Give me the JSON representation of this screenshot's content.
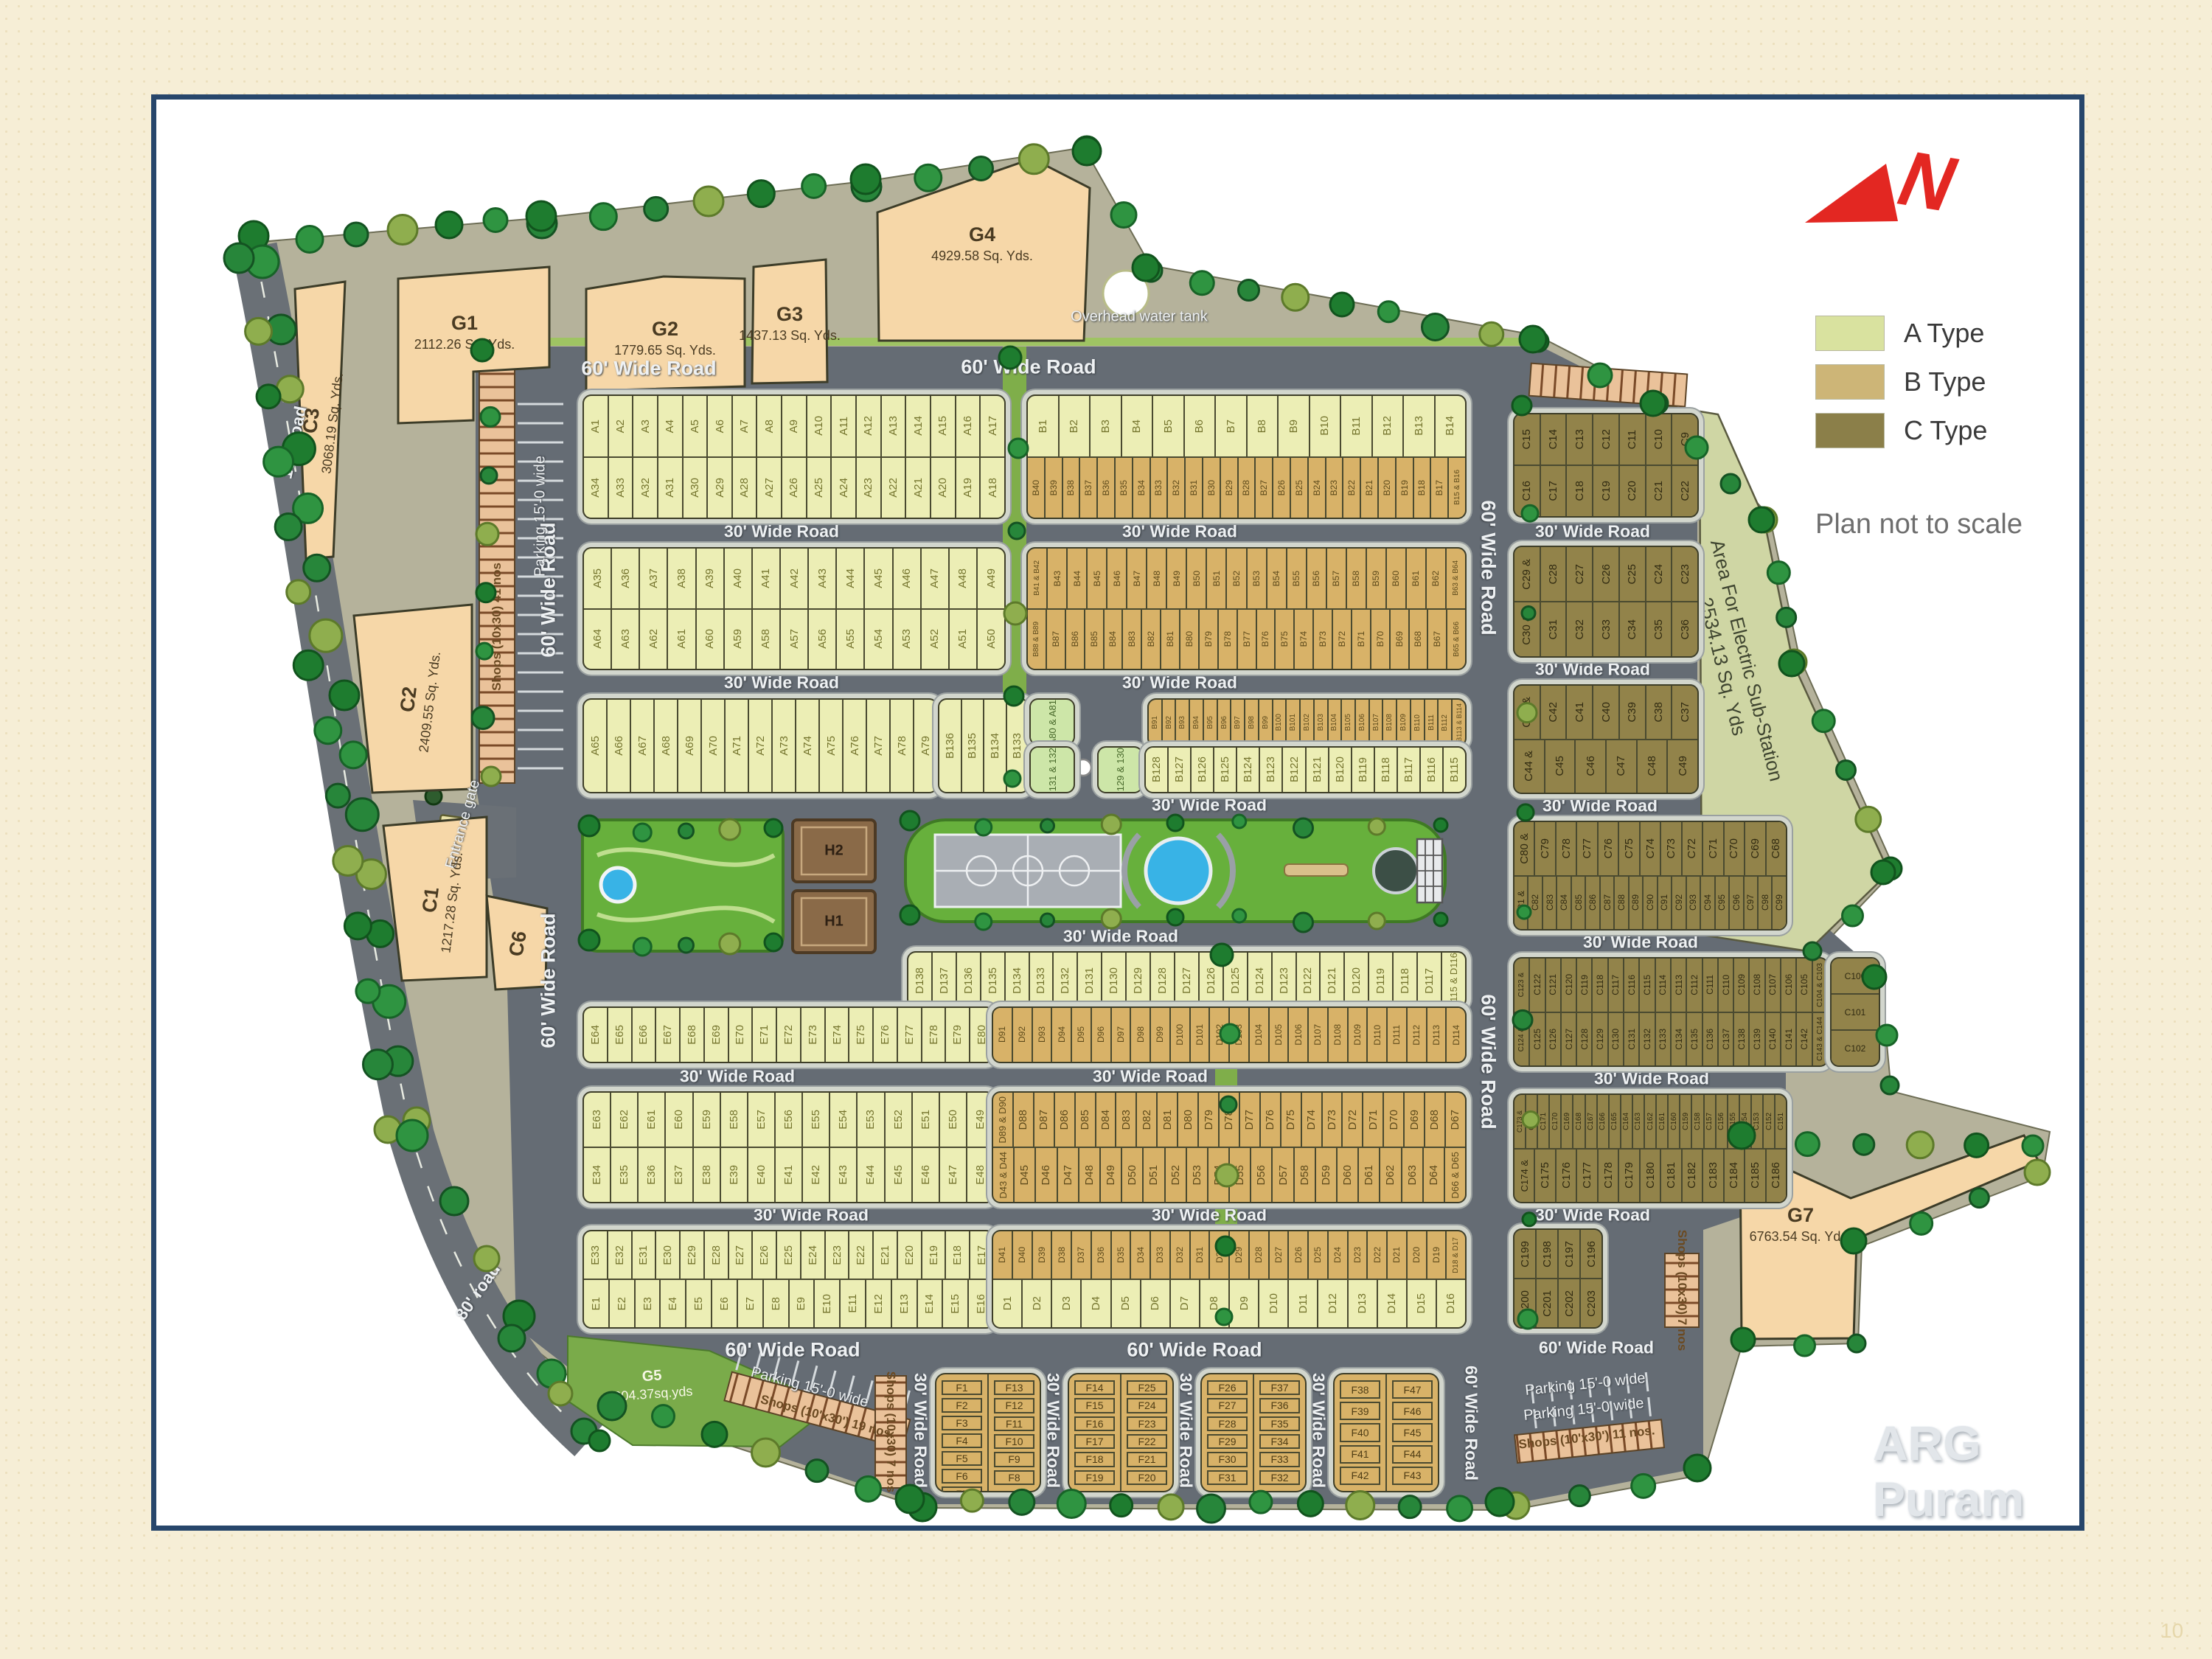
{
  "title": "ARG Puram",
  "page_number": "10",
  "north_letter": "N",
  "legend": {
    "items": [
      {
        "label": "A Type",
        "color": "#d9e29f"
      },
      {
        "label": "B Type",
        "color": "#cdb577"
      },
      {
        "label": "C Type",
        "color": "#8b7f49"
      }
    ],
    "note": "Plan not to scale"
  },
  "roads": {
    "sixty": "60' Wide Road",
    "thirty": "30' Wide Road",
    "hundred": "100' road",
    "eighty": "80' road"
  },
  "landmarks": {
    "tank": "Overhead water tank",
    "entrance": "Entrance gate",
    "substation_line1": "Area For Electric Sub-Station",
    "substation_line2": "2534.13 Sq. Yds"
  },
  "shops": {
    "parking15": "Parking 15'-0 wide",
    "shops41": "Shops (10x30) 41 nos",
    "shops19": "Shops (10'x30') 19 nos.",
    "shops11": "Shops (10'x30') 11 nos.",
    "shops7": "Shops (10x30) 7 nos"
  },
  "plots": {
    "G1": {
      "name": "G1",
      "area": "2112.26 Sq. Yds."
    },
    "G2": {
      "name": "G2",
      "area": "1779.65 Sq. Yds."
    },
    "G3": {
      "name": "G3",
      "area": "1437.13 Sq. Yds."
    },
    "G4": {
      "name": "G4",
      "area": "4929.58 Sq. Yds."
    },
    "G5": {
      "name": "G5",
      "area": "804.37sq.yds"
    },
    "G7": {
      "name": "G7",
      "area": "6763.54 Sq. Yda."
    },
    "C1": {
      "name": "C1",
      "area": "1217.28 Sq. Yds."
    },
    "C2": {
      "name": "C2",
      "area": "2409.55 Sq. Yds."
    },
    "C3": {
      "name": "C3",
      "area": "3068.19 Sq. Yds."
    },
    "C6": {
      "name": "C6",
      "area": ""
    },
    "H1": {
      "name": "H1"
    },
    "H2": {
      "name": "H2"
    }
  },
  "blocks": {
    "r1lt": [
      "A1",
      "A2",
      "A3",
      "A4",
      "A5",
      "A6",
      "A7",
      "A8",
      "A9",
      "A10",
      "A11",
      "A12",
      "A13",
      "A14",
      "A15",
      "A16",
      "A17"
    ],
    "r1lb": [
      "A34",
      "A33",
      "A32",
      "A31",
      "A30",
      "A29",
      "A28",
      "A27",
      "A26",
      "A25",
      "A24",
      "A23",
      "A22",
      "A21",
      "A20",
      "A19",
      "A18"
    ],
    "r1rt": [
      "B1",
      "B2",
      "B3",
      "B4",
      "B5",
      "B6",
      "B7",
      "B8",
      "B9",
      "B10",
      "B11",
      "B12",
      "B13",
      "B14"
    ],
    "r1rb": [
      "B40",
      "B39",
      "B38",
      "B37",
      "B36",
      "B35",
      "B34",
      "B33",
      "B32",
      "B31",
      "B30",
      "B29",
      "B28",
      "B27",
      "B26",
      "B25",
      "B24",
      "B23",
      "B22",
      "B21",
      "B20",
      "B19",
      "B18",
      "B17",
      "B15 & B16"
    ],
    "r2lt": [
      "A35",
      "A36",
      "A37",
      "A38",
      "A39",
      "A40",
      "A41",
      "A42",
      "A43",
      "A44",
      "A45",
      "A46",
      "A47",
      "A48",
      "A49"
    ],
    "r2lb": [
      "A64",
      "A63",
      "A62",
      "A61",
      "A60",
      "A59",
      "A58",
      "A57",
      "A56",
      "A55",
      "A54",
      "A53",
      "A52",
      "A51",
      "A50"
    ],
    "r2rt": [
      "B41 & B42",
      "B43",
      "B44",
      "B45",
      "B46",
      "B47",
      "B48",
      "B49",
      "B50",
      "B51",
      "B52",
      "B53",
      "B54",
      "B55",
      "B56",
      "B57",
      "B58",
      "B59",
      "B60",
      "B61",
      "B62",
      "B63 & B64"
    ],
    "r2rb": [
      "B88 & B89",
      "B87",
      "B86",
      "B85",
      "B84",
      "B83",
      "B82",
      "B81",
      "B80",
      "B79",
      "B78",
      "B77",
      "B76",
      "B75",
      "B74",
      "B73",
      "B72",
      "B71",
      "B70",
      "B69",
      "B68",
      "B67",
      "B65 & B66"
    ],
    "r3l": [
      "A65",
      "A66",
      "A67",
      "A68",
      "A69",
      "A70",
      "A71",
      "A72",
      "A73",
      "A74",
      "A75",
      "A76",
      "A77",
      "A78",
      "A79"
    ],
    "r3m": [
      "B136",
      "B135",
      "B134",
      "B133"
    ],
    "gA80": [
      "A80 & A81"
    ],
    "gB131": [
      "B131 & 132"
    ],
    "gB129": [
      "B129 & 130"
    ],
    "r3rt": [
      "B91",
      "B92",
      "B93",
      "B94",
      "B95",
      "B96",
      "B97",
      "B98",
      "B99",
      "B100",
      "B101",
      "B102",
      "B103",
      "B104",
      "B105",
      "B106",
      "B107",
      "B108",
      "B109",
      "B110",
      "B111",
      "B112",
      "B113 & B114"
    ],
    "r3rb": [
      "B128",
      "B127",
      "B126",
      "B125",
      "B124",
      "B123",
      "B122",
      "B121",
      "B120",
      "B119",
      "B118",
      "B117",
      "B116",
      "B115"
    ],
    "m1t": [
      "D138",
      "D137",
      "D136",
      "D135",
      "D134",
      "D133",
      "D132",
      "D131",
      "D130",
      "D129",
      "D128",
      "D127",
      "D126",
      "D125",
      "D124",
      "D123",
      "D122",
      "D121",
      "D120",
      "D119",
      "D118",
      "D117",
      "D115 & D116"
    ],
    "m1bl": [
      "E64",
      "E65",
      "E66",
      "E67",
      "E68",
      "E69",
      "E70",
      "E71",
      "E72",
      "E73",
      "E74",
      "E75",
      "E76",
      "E77",
      "E78",
      "E79",
      "E80"
    ],
    "m1br": [
      "D91",
      "D92",
      "D93",
      "D94",
      "D95",
      "D96",
      "D97",
      "D98",
      "D99",
      "D100",
      "D101",
      "D102",
      "D103",
      "D104",
      "D105",
      "D106",
      "D107",
      "D108",
      "D109",
      "D110",
      "D111",
      "D112",
      "D113",
      "D114"
    ],
    "m2tl": [
      "E63",
      "E62",
      "E61",
      "E60",
      "E59",
      "E58",
      "E57",
      "E56",
      "E55",
      "E54",
      "E53",
      "E52",
      "E51",
      "E50",
      "E49"
    ],
    "m2tr": [
      "D89 & D90",
      "D88",
      "D87",
      "D86",
      "D85",
      "D84",
      "D83",
      "D82",
      "D81",
      "D80",
      "D79",
      "D78",
      "D77",
      "D76",
      "D75",
      "D74",
      "D73",
      "D72",
      "D71",
      "D70",
      "D69",
      "D68",
      "D67"
    ],
    "m2bl": [
      "E34",
      "E35",
      "E36",
      "E37",
      "E38",
      "E39",
      "E40",
      "E41",
      "E42",
      "E43",
      "E44",
      "E45",
      "E46",
      "E47",
      "E48"
    ],
    "m2br": [
      "D43 & D44",
      "D45",
      "D46",
      "D47",
      "D48",
      "D49",
      "D50",
      "D51",
      "D52",
      "D53",
      "D54",
      "D55",
      "D56",
      "D57",
      "D58",
      "D59",
      "D60",
      "D61",
      "D62",
      "D63",
      "D64",
      "D66 & D65"
    ],
    "m3tl": [
      "E33",
      "E32",
      "E31",
      "E30",
      "E29",
      "E28",
      "E27",
      "E26",
      "E25",
      "E24",
      "E23",
      "E22",
      "E21",
      "E20",
      "E19",
      "E18",
      "E17"
    ],
    "m3tr": [
      "D41",
      "D40",
      "D39",
      "D38",
      "D37",
      "D36",
      "D35",
      "D34",
      "D33",
      "D32",
      "D31",
      "D30",
      "D29",
      "D28",
      "D27",
      "D26",
      "D25",
      "D24",
      "D23",
      "D22",
      "D21",
      "D20",
      "D19",
      "D18 & D17"
    ],
    "m3bl": [
      "E1",
      "E2",
      "E3",
      "E4",
      "E5",
      "E6",
      "E7",
      "E8",
      "E9",
      "E10",
      "E11",
      "E12",
      "E13",
      "E14",
      "E15",
      "E16"
    ],
    "m3br": [
      "D1",
      "D2",
      "D3",
      "D4",
      "D5",
      "D6",
      "D7",
      "D8",
      "D9",
      "D10",
      "D11",
      "D12",
      "D13",
      "D14",
      "D15",
      "D16"
    ],
    "f1l": [
      "F1",
      "F2",
      "F3",
      "F4",
      "F5",
      "F6",
      "F7"
    ],
    "f1r": [
      "F13",
      "F12",
      "F11",
      "F10",
      "F9",
      "F8"
    ],
    "f2l": [
      "F14",
      "F15",
      "F16",
      "F17",
      "F18",
      "F19"
    ],
    "f2r": [
      "F25",
      "F24",
      "F23",
      "F22",
      "F21",
      "F20"
    ],
    "f3l": [
      "F26",
      "F27",
      "F28",
      "F29",
      "F30",
      "F31"
    ],
    "f3r": [
      "F37",
      "F36",
      "F35",
      "F34",
      "F33",
      "F32"
    ],
    "f4l": [
      "F38",
      "F39",
      "F40",
      "F41",
      "F42"
    ],
    "f4r": [
      "F47",
      "F46",
      "F45",
      "F44",
      "F43"
    ],
    "c1t": [
      "C15",
      "C14",
      "C13",
      "C12",
      "C11",
      "C10",
      "C9"
    ],
    "c1b": [
      "C16",
      "C17",
      "C18",
      "C19",
      "C20",
      "C21",
      "C22"
    ],
    "c2t": [
      "C29 &",
      "C28",
      "C27",
      "C26",
      "C25",
      "C24",
      "C23"
    ],
    "c2b": [
      "C30 &",
      "C31",
      "C32",
      "C33",
      "C34",
      "C35",
      "C36"
    ],
    "c3t": [
      "C43 &",
      "C42",
      "C41",
      "C40",
      "C39",
      "C38",
      "C37"
    ],
    "c3b": [
      "C44 &",
      "C45",
      "C46",
      "C47",
      "C48",
      "C49"
    ],
    "c4t": [
      "C80 &",
      "C79",
      "C78",
      "C77",
      "C76",
      "C75",
      "C74",
      "C73",
      "C72",
      "C71",
      "C70",
      "C69",
      "C68"
    ],
    "c4b": [
      "C81 &",
      "C82",
      "C83",
      "C84",
      "C85",
      "C86",
      "C87",
      "C88",
      "C89",
      "C90",
      "C91",
      "C92",
      "C93",
      "C94",
      "C95",
      "C96",
      "C97",
      "C98",
      "C99"
    ],
    "ccorner": [
      "C100",
      "C101",
      "C102"
    ],
    "c5t": [
      "C123 &",
      "C122",
      "C121",
      "C120",
      "C119",
      "C118",
      "C117",
      "C116",
      "C115",
      "C114",
      "C113",
      "C112",
      "C111",
      "C110",
      "C109",
      "C108",
      "C107",
      "C106",
      "C105",
      "C104 & C103"
    ],
    "c5b": [
      "C124 &",
      "C125",
      "C126",
      "C127",
      "C128",
      "C129",
      "C130",
      "C131",
      "C132",
      "C133",
      "C134",
      "C135",
      "C136",
      "C137",
      "C138",
      "C139",
      "C140",
      "C141",
      "C142",
      "C143 & C144"
    ],
    "c6t": [
      "C173 &",
      "C172",
      "C171",
      "C170",
      "C169",
      "C168",
      "C167",
      "C166",
      "C165",
      "C164",
      "C163",
      "C162",
      "C161",
      "C160",
      "C159",
      "C158",
      "C157",
      "C156",
      "C155",
      "C154",
      "C153",
      "C152",
      "C151"
    ],
    "c6b": [
      "C174 &",
      "C175",
      "C176",
      "C177",
      "C178",
      "C179",
      "C180",
      "C181",
      "C182",
      "C183",
      "C184",
      "C185",
      "C186"
    ],
    "c7t": [
      "C199",
      "C198",
      "C197",
      "C196"
    ],
    "c7b": [
      "C200",
      "C201",
      "C202",
      "C203"
    ]
  }
}
